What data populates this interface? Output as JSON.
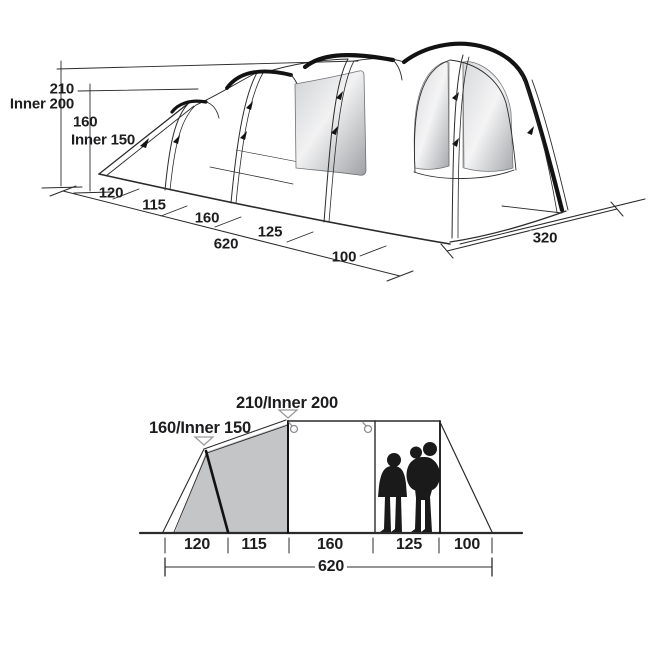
{
  "figure": {
    "perspective_view": {
      "title": "tent 3d perspective view",
      "heights": {
        "outer_peak": "210",
        "inner_peak": "Inner 200",
        "outer_rear": "160",
        "inner_rear": "Inner 150"
      },
      "floor_sections_cm": [
        "120",
        "115",
        "160",
        "125",
        "100"
      ],
      "total_length_cm": "620",
      "width_cm": "320"
    },
    "side_view": {
      "title": "tent side elevation view",
      "rear_peak_label": "160/Inner 150",
      "main_peak_label": "210/Inner 200",
      "floor_sections_cm": [
        "120",
        "115",
        "160",
        "125",
        "100"
      ],
      "total_length_cm": "620"
    },
    "colors": {
      "line": "#2b2b2b",
      "pole_black": "#121212",
      "panel_gray": "#c3c5c7",
      "marker_gray": "#9a9c9e",
      "window_gradient_start": "#cfd1d3",
      "window_gradient_mid": "#f2f2f3",
      "window_gradient_end": "#9ea1a4"
    }
  }
}
